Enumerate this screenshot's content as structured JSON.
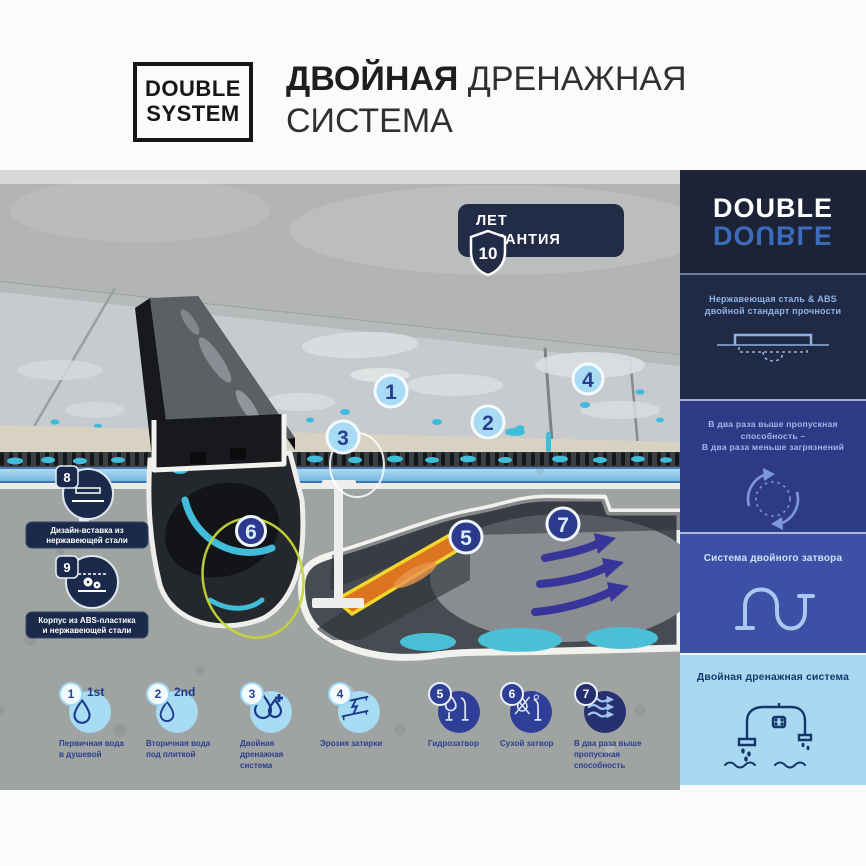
{
  "header": {
    "logo_line1": "DOUBLE",
    "logo_line2": "SYSTEM",
    "title_bold": "ДВОЙНАЯ",
    "title_light": " ДРЕНАЖНАЯ",
    "title_line2": "СИСТЕМА"
  },
  "badge": {
    "number": "10",
    "line1": "ЛЕТ",
    "line2": "ГАРАНТИЯ"
  },
  "sidebar": {
    "logo": "DOUBLE",
    "logo_mirror": "DOUBLE",
    "panels": [
      {
        "lines": [
          "Нержавеющая сталь & ABS",
          "двойной стандарт прочности"
        ]
      },
      {
        "lines": [
          "В два раза выше пропускная способность –",
          "В два раза меньше загрязнений"
        ]
      },
      {
        "lines": [
          "Система двойного затвора"
        ]
      },
      {
        "lines": [
          "Двойная дренажная система"
        ]
      }
    ]
  },
  "markers": {
    "m1": "1",
    "m2": "2",
    "m3": "3",
    "m4": "4",
    "m5": "5",
    "m6": "6",
    "m7": "7"
  },
  "callouts": {
    "c8": {
      "num": "8",
      "label": [
        "Дизайн-вставка из",
        "нержавеющей стали"
      ]
    },
    "c9": {
      "num": "9",
      "label": [
        "Корпус из ABS-пластика",
        "и нержавеющей стали"
      ]
    }
  },
  "legend": [
    {
      "num": "1",
      "tag": "1st",
      "lines": [
        "Первичная вода",
        "в душевой"
      ]
    },
    {
      "num": "2",
      "tag": "2nd",
      "lines": [
        "Вторичная вода",
        "под плиткой"
      ]
    },
    {
      "num": "3",
      "tag": "",
      "lines": [
        "Двойная",
        "дренажная",
        "система"
      ]
    },
    {
      "num": "4",
      "tag": "",
      "lines": [
        "Эрозия затирки"
      ]
    },
    {
      "num": "5",
      "tag": "",
      "lines": [
        "Гидрозатвор"
      ]
    },
    {
      "num": "6",
      "tag": "",
      "lines": [
        "Сухой затвор"
      ]
    },
    {
      "num": "7",
      "tag": "",
      "lines": [
        "В два раза выше",
        "пропускная",
        "способность"
      ]
    }
  ],
  "colors": {
    "navy": "#232c47",
    "panel_indigo": "#2e3a86",
    "panel_blue": "#3c51a5",
    "panel_light": "#a9d9f1",
    "marker_light": "#a7dcf4",
    "marker_navy": "#2c3a8e",
    "water_teal": "#41bcd9",
    "orange": "#dd7420",
    "yellow": "#f2d62c",
    "arrow_blue": "#37349a"
  }
}
